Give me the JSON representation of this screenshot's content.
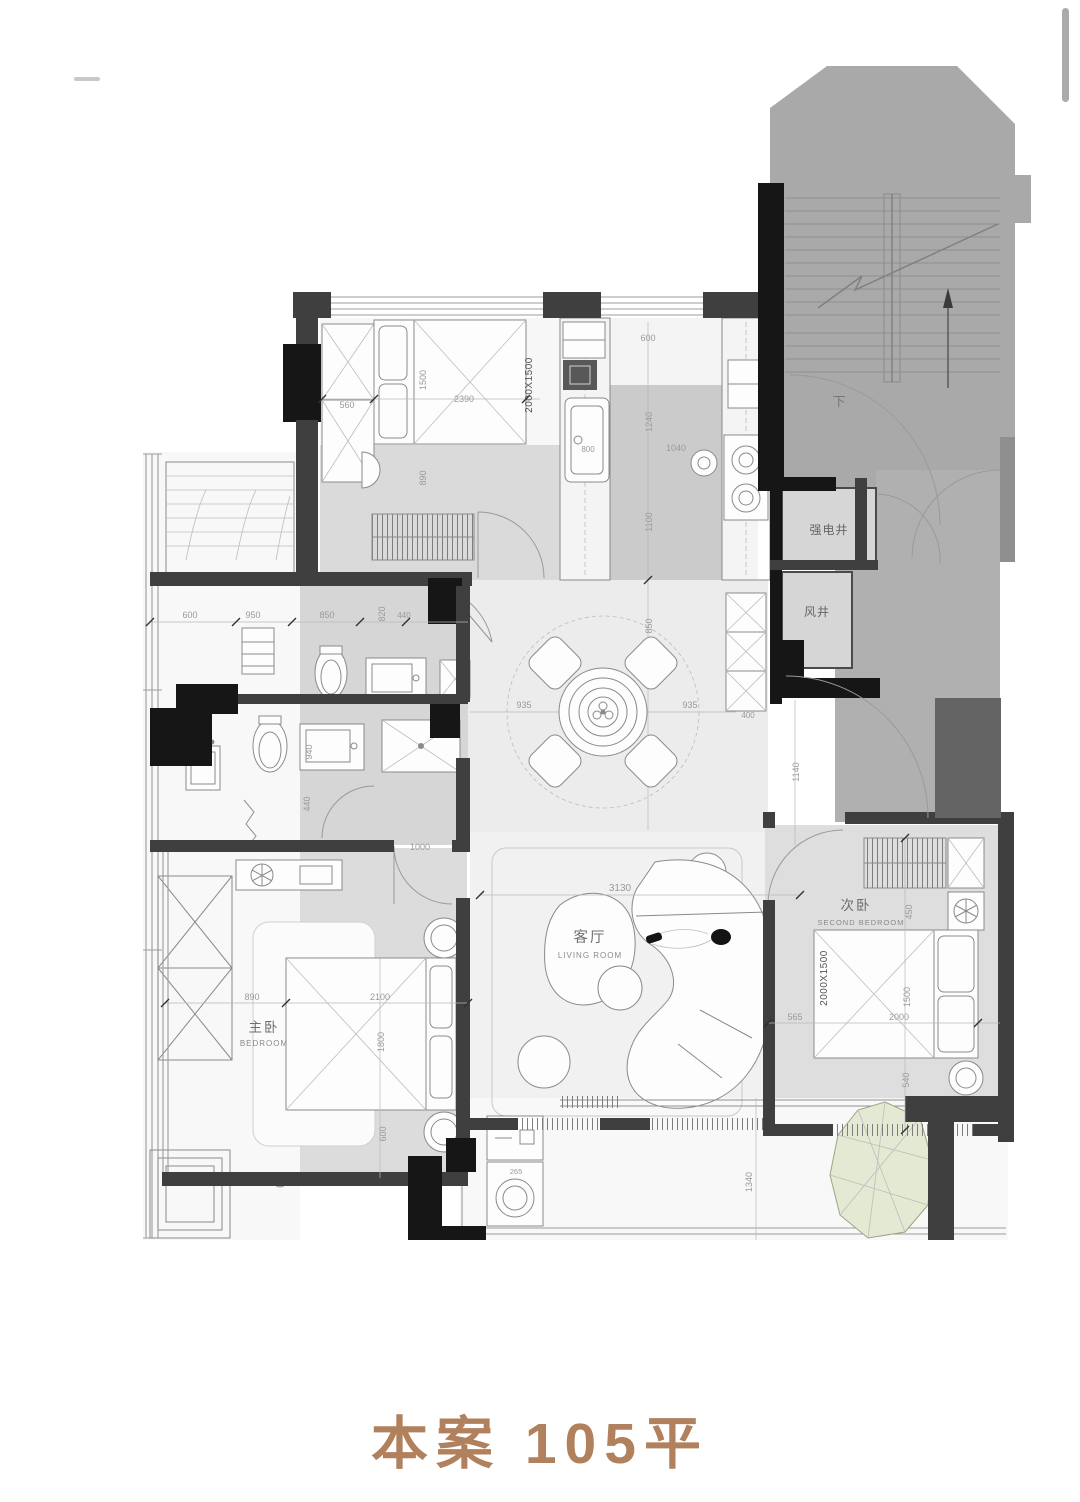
{
  "caption": "本案 105平",
  "rooms": {
    "living_zh": "客厅",
    "living_en": "LIVING ROOM",
    "master_zh": "主卧",
    "master_en": "BEDROOM",
    "second_zh": "次卧",
    "second_en": "SECOND BEDROOM",
    "elec_shaft": "强电井",
    "air_shaft": "风井",
    "stairs_down": "下"
  },
  "furniture": {
    "bed1_size": "2000X1500",
    "bed2_size": "2000X1500",
    "washer_dim": "265"
  },
  "dims": {
    "bd1_wardrobe": "560",
    "bd1_bed_w": "1500",
    "bd1_room_w": "2390",
    "bd1_below": "890",
    "kit_top": "600",
    "kit_left": "1240",
    "kit_mid": "1040",
    "kit_low": "1100",
    "kit_sink": "800",
    "din_top": "850",
    "din_left": "935",
    "din_right": "935",
    "din_cab": "400",
    "bath_1": "600",
    "bath_2": "950",
    "bath_3": "850",
    "bath_4": "820",
    "bath_5": "440",
    "bath_6": "940",
    "bath_7": "440",
    "hall_w": "1000",
    "mbr_1": "890",
    "mbr_2": "2100",
    "mbr_3": "1800",
    "mbr_4": "600",
    "liv_w": "3130",
    "sbr_1": "450",
    "sbr_2": "565",
    "sbr_3": "2000",
    "sbr_4": "1500",
    "sbr_5": "540",
    "entry_v": "1140",
    "balc_v": "1340"
  },
  "colors": {
    "caption": "#b1805c",
    "wall_dark": "#3f3f3f",
    "wall_black": "#161616",
    "stair_gray": "#a9a9a9",
    "floor_gray": "#dcdcdc",
    "plant_green": "#e3e9d3"
  }
}
